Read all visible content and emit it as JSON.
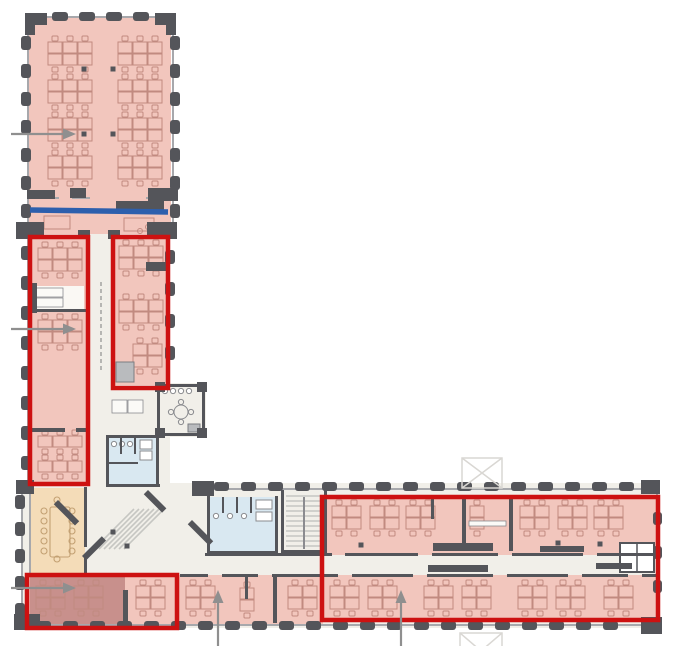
{
  "figure": {
    "name": "office-floor-plan",
    "description_label": "L-shaped building floor plan with highlighted office zones",
    "width": 691,
    "height": 646
  },
  "colors": {
    "bg": "#ffffff",
    "floor": "#f1efe9",
    "floor2": "#faf8f4",
    "pink": "#f2c6bd",
    "pink_dark": "#c8908c",
    "tan": "#f4dcb8",
    "tan_stroke": "#c3a173",
    "blue_room": "#d9e8f1",
    "red": "#cd1111",
    "blue_line": "#2d5fad",
    "wall": "#54555a",
    "wall_light": "#a7a8ac",
    "furniture": "#c18a80",
    "gray_furn": "#8a8b8f",
    "gray_fill": "#b9bbbe",
    "stair": "#c6c6c2",
    "marker": "#d9d7d3",
    "arrow": "#8f8f8f"
  },
  "floors": [
    [
      27,
      230,
      143,
      350
    ],
    [
      158,
      383,
      48,
      54
    ],
    [
      21,
      483,
      639,
      145
    ]
  ],
  "zones": [
    {
      "name": "top-wing-open-office",
      "color": "pink",
      "rect": [
        29,
        18,
        142,
        216
      ]
    },
    {
      "name": "left-box-rooms",
      "color": "pink",
      "rect": [
        31,
        239,
        56,
        244
      ]
    },
    {
      "name": "shelf-room",
      "color": "floor2",
      "rect": [
        33,
        286,
        51,
        23
      ]
    },
    {
      "name": "right-box-rooms",
      "color": "pink",
      "rect": [
        115,
        239,
        51,
        146
      ]
    },
    {
      "name": "meeting-room-tan",
      "color": "tan",
      "rect": [
        30,
        488,
        55,
        85
      ]
    },
    {
      "name": "bottom-left-room-pink",
      "color": "pink",
      "rect": [
        29,
        576,
        146,
        48
      ]
    },
    {
      "name": "bottom-left-room-dark",
      "color": "pink_dark",
      "rect": [
        30,
        576,
        95,
        48
      ]
    },
    {
      "name": "lower-mid-rooms",
      "color": "pink",
      "rect": [
        177,
        575,
        146,
        49
      ]
    },
    {
      "name": "east-wing-upper-rooms",
      "color": "pink",
      "rect": [
        324,
        498,
        332,
        57
      ]
    },
    {
      "name": "east-wing-lower-rooms",
      "color": "pink",
      "rect": [
        324,
        575,
        332,
        45
      ]
    },
    {
      "name": "core-bathroom",
      "color": "blue_room",
      "rect": [
        107,
        436,
        52,
        50
      ]
    },
    {
      "name": "wing-bathroom",
      "color": "blue_room",
      "rect": [
        208,
        497,
        70,
        56
      ]
    }
  ],
  "walls_light": [
    [
      27,
      16,
      147,
      2
    ],
    [
      27,
      16,
      2,
      218
    ],
    [
      172,
      16,
      2,
      218
    ],
    [
      27,
      234,
      2,
      253
    ],
    [
      167,
      234,
      2,
      151
    ],
    [
      27,
      197,
      32,
      2
    ],
    [
      72,
      197,
      18,
      2
    ],
    [
      146,
      197,
      28,
      2
    ],
    [
      21,
      487,
      2,
      140
    ],
    [
      205,
      488,
      453,
      2
    ],
    [
      23,
      624,
      636,
      2
    ],
    [
      656,
      490,
      2,
      136
    ],
    [
      29,
      487,
      2,
      88
    ],
    [
      29,
      573,
      58,
      2
    ]
  ],
  "walls_dark": [
    [
      106,
      435,
      54,
      3
    ],
    [
      106,
      435,
      3,
      52
    ],
    [
      156,
      435,
      3,
      52
    ],
    [
      106,
      484,
      54,
      3
    ],
    [
      120,
      438,
      2,
      16
    ],
    [
      134,
      438,
      2,
      16
    ],
    [
      106,
      462,
      32,
      2
    ],
    [
      207,
      496,
      3,
      58
    ],
    [
      275,
      496,
      3,
      58
    ],
    [
      207,
      551,
      71,
      3
    ],
    [
      222,
      497,
      2,
      16
    ],
    [
      236,
      497,
      2,
      16
    ],
    [
      250,
      497,
      2,
      16
    ],
    [
      281,
      490,
      3,
      63
    ],
    [
      324,
      490,
      3,
      63
    ],
    [
      281,
      550,
      46,
      3
    ],
    [
      157,
      384,
      49,
      3
    ],
    [
      157,
      384,
      3,
      53
    ],
    [
      202,
      384,
      3,
      53
    ],
    [
      157,
      433,
      49,
      3
    ],
    [
      84,
      487,
      3,
      60
    ],
    [
      84,
      555,
      3,
      20
    ],
    [
      205,
      553,
      127,
      3
    ],
    [
      345,
      553,
      73,
      3
    ],
    [
      432,
      553,
      66,
      3
    ],
    [
      512,
      553,
      71,
      3
    ],
    [
      597,
      553,
      59,
      3
    ],
    [
      180,
      574,
      28,
      3
    ],
    [
      222,
      574,
      36,
      3
    ],
    [
      272,
      574,
      66,
      3
    ],
    [
      352,
      574,
      61,
      3
    ],
    [
      427,
      574,
      66,
      3
    ],
    [
      507,
      574,
      61,
      3
    ],
    [
      582,
      574,
      46,
      3
    ],
    [
      642,
      574,
      14,
      3
    ],
    [
      431,
      499,
      3,
      20
    ],
    [
      462,
      499,
      4,
      52
    ],
    [
      509,
      499,
      4,
      52
    ],
    [
      273,
      577,
      4,
      46
    ],
    [
      245,
      577,
      3,
      22
    ],
    [
      123,
      590,
      5,
      34
    ],
    [
      31,
      283,
      6,
      30
    ],
    [
      31,
      309,
      56,
      3
    ],
    [
      31,
      428,
      34,
      4
    ],
    [
      76,
      428,
      11,
      4
    ],
    [
      146,
      262,
      20,
      9
    ],
    [
      116,
      201,
      48,
      9
    ],
    [
      27,
      228,
      13,
      11
    ],
    [
      78,
      230,
      12,
      9
    ],
    [
      108,
      230,
      12,
      9
    ],
    [
      158,
      228,
      14,
      11
    ],
    [
      433,
      543,
      60,
      8
    ],
    [
      540,
      546,
      44,
      6
    ],
    [
      428,
      565,
      60,
      7
    ],
    [
      596,
      563,
      36,
      6
    ]
  ],
  "corner_blocks": [
    [
      27,
      13,
      20,
      12
    ],
    [
      155,
      13,
      21,
      12
    ],
    [
      25,
      13,
      10,
      22
    ],
    [
      166,
      13,
      10,
      22
    ],
    [
      16,
      222,
      28,
      17
    ],
    [
      147,
      222,
      30,
      17
    ],
    [
      70,
      188,
      16,
      10
    ],
    [
      148,
      188,
      30,
      13
    ],
    [
      27,
      190,
      28,
      9
    ],
    [
      16,
      480,
      18,
      14
    ],
    [
      192,
      481,
      22,
      15
    ],
    [
      14,
      614,
      26,
      16
    ],
    [
      641,
      480,
      19,
      14
    ],
    [
      641,
      617,
      21,
      17
    ],
    [
      155,
      382,
      10,
      10
    ],
    [
      197,
      382,
      10,
      10
    ],
    [
      155,
      428,
      10,
      10
    ],
    [
      197,
      428,
      10,
      10
    ]
  ],
  "pilaster_runs": [
    {
      "x": 21,
      "y": 36,
      "dx": 0,
      "dy": 28,
      "count": 7,
      "w": 10,
      "h": 14
    },
    {
      "x": 170,
      "y": 36,
      "dx": 0,
      "dy": 28,
      "count": 7,
      "w": 10,
      "h": 14
    },
    {
      "x": 52,
      "y": 12,
      "dx": 27,
      "dy": 0,
      "count": 4,
      "w": 16,
      "h": 9
    },
    {
      "x": 21,
      "y": 246,
      "dx": 0,
      "dy": 30,
      "count": 8,
      "w": 10,
      "h": 14
    },
    {
      "x": 165,
      "y": 250,
      "dx": 0,
      "dy": 32,
      "count": 4,
      "w": 10,
      "h": 14
    },
    {
      "x": 15,
      "y": 495,
      "dx": 0,
      "dy": 27,
      "count": 5,
      "w": 10,
      "h": 14
    },
    {
      "x": 214,
      "y": 482,
      "dx": 27,
      "dy": 0,
      "count": 16,
      "w": 15,
      "h": 9
    },
    {
      "x": 36,
      "y": 621,
      "dx": 27,
      "dy": 0,
      "count": 22,
      "w": 15,
      "h": 9
    },
    {
      "x": 653,
      "y": 512,
      "dx": 0,
      "dy": 34,
      "count": 3,
      "w": 9,
      "h": 13
    }
  ],
  "furniture": {
    "clusters": [
      [
        48,
        42,
        3,
        2
      ],
      [
        118,
        42,
        3,
        2
      ],
      [
        48,
        80,
        3,
        2
      ],
      [
        118,
        80,
        3,
        2
      ],
      [
        48,
        118,
        3,
        2
      ],
      [
        118,
        118,
        3,
        2
      ],
      [
        48,
        156,
        3,
        2
      ],
      [
        118,
        156,
        3,
        2
      ],
      [
        38,
        248,
        3,
        2
      ],
      [
        38,
        320,
        3,
        2
      ],
      [
        38,
        436,
        3,
        1
      ],
      [
        38,
        461,
        3,
        1
      ],
      [
        119,
        246,
        3,
        2
      ],
      [
        119,
        300,
        3,
        2
      ],
      [
        133,
        344,
        2,
        2
      ],
      [
        36,
        586,
        2,
        2
      ],
      [
        74,
        586,
        2,
        2
      ],
      [
        136,
        586,
        2,
        2
      ],
      [
        186,
        586,
        2,
        2
      ],
      [
        240,
        588,
        1,
        2
      ],
      [
        288,
        586,
        2,
        2
      ],
      [
        330,
        586,
        2,
        2
      ],
      [
        368,
        586,
        2,
        2
      ],
      [
        424,
        586,
        2,
        2
      ],
      [
        462,
        586,
        2,
        2
      ],
      [
        518,
        586,
        2,
        2
      ],
      [
        556,
        586,
        2,
        2
      ],
      [
        604,
        586,
        2,
        2
      ],
      [
        332,
        506,
        2,
        2
      ],
      [
        370,
        506,
        2,
        2
      ],
      [
        406,
        506,
        2,
        2
      ],
      [
        470,
        506,
        1,
        2
      ],
      [
        520,
        506,
        2,
        2
      ],
      [
        558,
        506,
        2,
        2
      ],
      [
        594,
        506,
        2,
        2
      ]
    ],
    "tables": [
      [
        44,
        216,
        26,
        13
      ],
      [
        124,
        218,
        30,
        13
      ]
    ],
    "loose_chairs": [
      [
        140,
        231
      ],
      [
        148,
        227
      ],
      [
        156,
        231
      ],
      [
        163,
        226
      ]
    ],
    "conference_table": {
      "rect": [
        50,
        507,
        20,
        50
      ],
      "left_x": 44,
      "right_x": 72,
      "chair_ys": [
        511,
        521,
        531,
        541,
        551
      ],
      "top": [
        57,
        500
      ],
      "bottom": [
        57,
        559
      ]
    },
    "round_table": {
      "cx": 181,
      "cy": 412,
      "r": 7,
      "chairs": [
        [
          181,
          402
        ],
        [
          191,
          412
        ],
        [
          181,
          422
        ],
        [
          171,
          412
        ]
      ]
    },
    "counter_circles": [
      [
        165,
        391
      ],
      [
        173,
        391
      ],
      [
        181,
        391
      ],
      [
        189,
        391
      ]
    ],
    "bath_circles": [
      [
        114,
        444
      ],
      [
        122,
        444
      ],
      [
        130,
        444
      ],
      [
        216,
        516
      ],
      [
        230,
        516
      ],
      [
        244,
        516
      ]
    ],
    "bath_rects": [
      [
        140,
        440,
        12,
        9
      ],
      [
        140,
        451,
        12,
        9
      ],
      [
        256,
        500,
        16,
        9
      ],
      [
        256,
        512,
        16,
        9
      ]
    ],
    "shelves": [
      [
        34,
        288,
        29,
        9
      ],
      [
        34,
        298,
        29,
        9
      ],
      [
        112,
        400,
        15,
        13
      ],
      [
        128,
        400,
        15,
        13
      ],
      [
        469,
        521,
        37,
        5
      ],
      [
        124,
        203,
        16,
        5
      ]
    ],
    "elevator": {
      "rect": [
        620,
        543,
        34,
        29
      ],
      "divider_x": 637
    },
    "copier": [
      116,
      362,
      18,
      20
    ],
    "appliance": [
      188,
      424,
      12,
      8
    ]
  },
  "stairs": {
    "core_diagonal": {
      "x": 94,
      "y": 549,
      "dx": 5,
      "count": 7,
      "len": 40
    },
    "wing_straight": {
      "x1": 286,
      "x2": 323,
      "y": 496,
      "dy": 5,
      "count": 11,
      "rail": [
        303,
        497,
        2,
        52
      ]
    },
    "diag_bars": [
      {
        "x": 58,
        "y": 500,
        "len": 30,
        "rot": 45
      },
      {
        "x": 148,
        "y": 490,
        "len": 26,
        "rot": 45
      },
      {
        "x": 192,
        "y": 520,
        "len": 30,
        "rot": 45
      },
      {
        "x": 82,
        "y": 556,
        "len": 28,
        "rot": -45
      }
    ]
  },
  "columns_dots": [
    [
      84,
      69
    ],
    [
      113,
      69
    ],
    [
      84,
      134
    ],
    [
      113,
      134
    ],
    [
      113,
      532
    ],
    [
      127,
      546
    ],
    [
      361,
      545
    ],
    [
      558,
      543
    ],
    [
      600,
      544
    ]
  ],
  "dashed_line": {
    "x": 101,
    "y1": 282,
    "y2": 372
  },
  "annotations": {
    "red_boxes": [
      {
        "name": "red-box-left-wing-offices",
        "rect": [
          30,
          237,
          58,
          247
        ]
      },
      {
        "name": "red-box-corridor-offices",
        "rect": [
          113,
          237,
          55,
          151
        ]
      },
      {
        "name": "red-box-bottom-left-room",
        "rect": [
          27,
          575,
          150,
          53
        ]
      },
      {
        "name": "red-box-east-wing",
        "rect": [
          322,
          497,
          336,
          123
        ]
      }
    ],
    "section_line": {
      "x1": 30,
      "y1": 210,
      "x2": 168,
      "y2": 212,
      "width": 5.5
    },
    "arrows": [
      {
        "name": "arrow-top-wing",
        "x1": 11,
        "y1": 134,
        "x2": 76,
        "y2": 134
      },
      {
        "name": "arrow-left-wing-room",
        "x1": 11,
        "y1": 329,
        "x2": 76,
        "y2": 329
      },
      {
        "name": "arrow-bottom-left-room",
        "x1": 11,
        "y1": 588,
        "x2": 76,
        "y2": 588
      },
      {
        "name": "arrow-lower-room-a",
        "x1": 218,
        "y1": 646,
        "x2": 218,
        "y2": 590
      },
      {
        "name": "arrow-lower-room-b",
        "x1": 401,
        "y1": 646,
        "x2": 401,
        "y2": 590
      }
    ],
    "x_markers": [
      [
        462,
        458,
        40,
        30
      ],
      [
        460,
        633,
        42,
        36
      ]
    ]
  }
}
